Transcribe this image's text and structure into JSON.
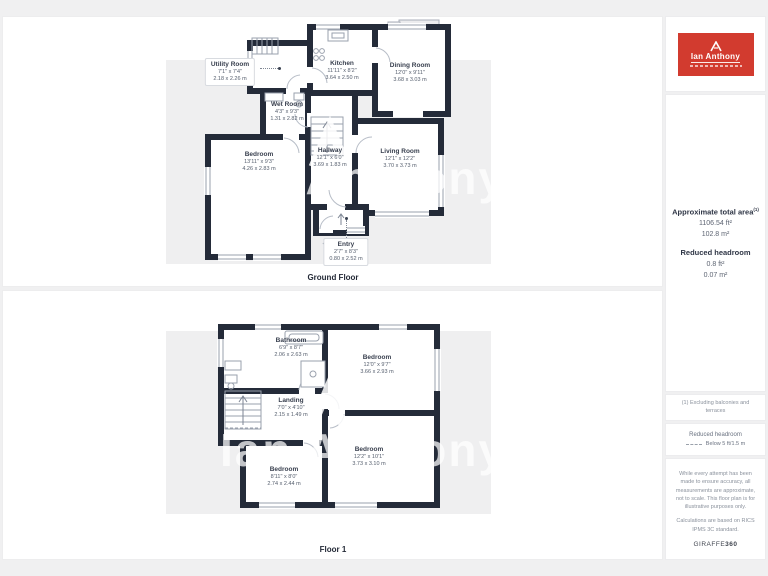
{
  "watermark": {
    "text": "Ian Anthony"
  },
  "colors": {
    "wall": "#242b39",
    "canvas": "#efeff0",
    "logo_red": "#d23b2f"
  },
  "floors": [
    {
      "title": "Ground Floor",
      "rooms": [
        {
          "name": "Utility Room",
          "imperial": "7'1\" x 7'4\"",
          "metric": "2.18 x 2.26 m"
        },
        {
          "name": "Kitchen",
          "imperial": "11'11\" x 8'2\"",
          "metric": "3.64 x 2.50 m"
        },
        {
          "name": "Dining Room",
          "imperial": "12'0\" x 9'11\"",
          "metric": "3.68 x 3.03 m"
        },
        {
          "name": "Wet Room",
          "imperial": "4'3\" x 9'3\"",
          "metric": "1.31 x 2.82 m"
        },
        {
          "name": "Bedroom",
          "imperial": "13'11\" x 9'3\"",
          "metric": "4.26 x 2.83 m"
        },
        {
          "name": "Hallway",
          "imperial": "12'1\" x 6'0\"",
          "metric": "3.69 x 1.83 m"
        },
        {
          "name": "Living Room",
          "imperial": "12'1\" x 12'2\"",
          "metric": "3.70 x 3.73 m"
        },
        {
          "name": "Entry",
          "imperial": "2'7\" x 8'3\"",
          "metric": "0.80 x 2.52 m"
        }
      ]
    },
    {
      "title": "Floor 1",
      "rooms": [
        {
          "name": "Bathroom",
          "imperial": "6'9\" x 8'7\"",
          "metric": "2.06 x 2.63 m"
        },
        {
          "name": "Bedroom",
          "imperial": "12'0\" x 9'7\"",
          "metric": "3.66 x 2.93 m"
        },
        {
          "name": "Landing",
          "imperial": "7'0\" x 4'10\"",
          "metric": "2.15 x 1.49 m"
        },
        {
          "name": "Bedroom",
          "imperial": "12'2\" x 10'1\"",
          "metric": "3.73 x 3.10 m"
        },
        {
          "name": "Bedroom",
          "imperial": "8'11\" x 8'0\"",
          "metric": "2.74 x 2.44 m"
        }
      ]
    }
  ],
  "sidebar": {
    "brand": "Ian Anthony",
    "area_title": "Approximate total area",
    "area_sup": "(1)",
    "area_ft": "1106.54 ft²",
    "area_m": "102.8 m²",
    "reduced_title": "Reduced headroom",
    "reduced_ft": "0.8 ft²",
    "reduced_m": "0.07 m²",
    "note": "(1) Excluding balconies and terraces",
    "legend_title": "Reduced headroom",
    "legend_value": "Below 5 ft/1.5 m",
    "disclaimer": "While every attempt has been made to ensure accuracy, all measurements are approximate, not to scale. This floor plan is for illustrative purposes only.",
    "standard": "Calculations are based on RICS IPMS 3C standard.",
    "giraffe": "GIRAFFE",
    "giraffe_num": "360"
  }
}
